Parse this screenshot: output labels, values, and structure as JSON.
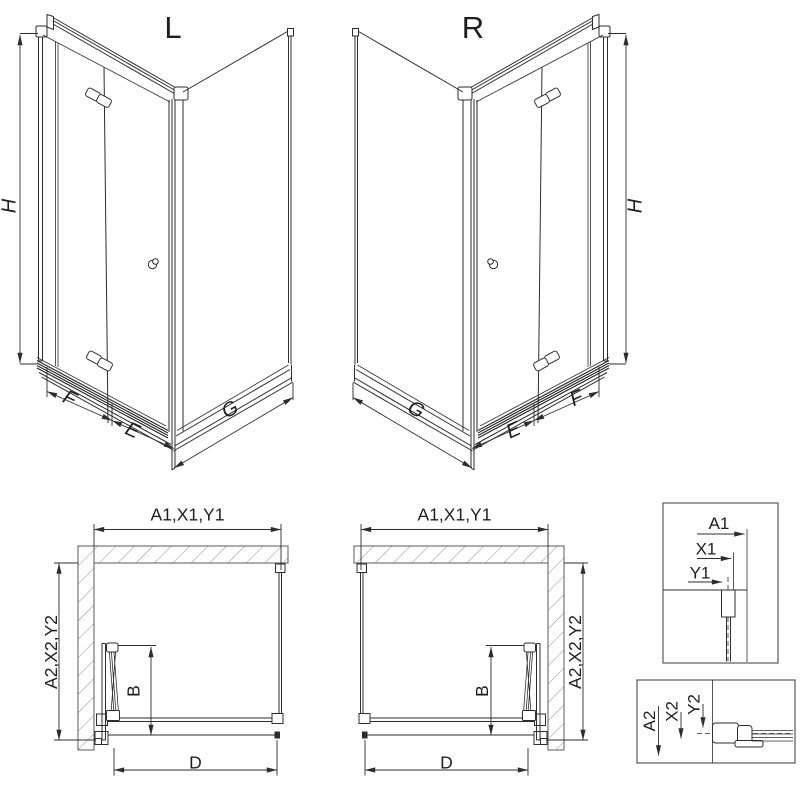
{
  "iso": {
    "left": {
      "title": "L",
      "height": "H",
      "door_fixed": "F",
      "door_leaf": "E",
      "side_panel": "G"
    },
    "right": {
      "title": "R",
      "height": "H",
      "door_fixed": "F",
      "door_leaf": "E",
      "side_panel": "G"
    }
  },
  "plan": {
    "left": {
      "width_dims": "A1,X1,Y1",
      "depth_dims": "A2,X2,Y2",
      "fold_depth": "B",
      "entry_width": "D"
    },
    "right": {
      "width_dims": "A1,X1,Y1",
      "depth_dims": "A2,X2,Y2",
      "fold_depth": "B",
      "entry_width": "D"
    }
  },
  "detail_width": {
    "a": "A1",
    "x": "X1",
    "y": "Y1"
  },
  "detail_depth": {
    "a": "A2",
    "x": "X2",
    "y": "Y2"
  },
  "colors": {
    "line": "#2d2d2d",
    "wall_outline": "#5a5a5a",
    "hatch": "#8f8f8f",
    "background": "#ffffff"
  }
}
